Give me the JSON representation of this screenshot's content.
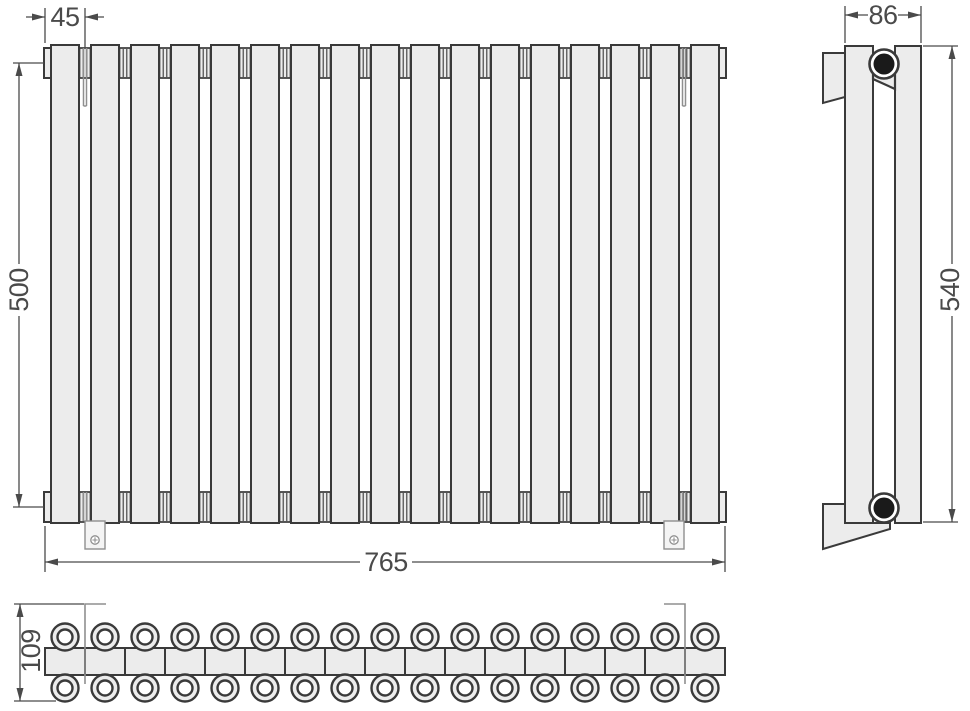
{
  "drawing": {
    "section_count": 17,
    "tube_rows": 2,
    "dimensions": {
      "bracket_offset_mm": "45",
      "center_distance_mm": "500",
      "width_mm": "765",
      "depth_mm": "86",
      "height_mm": "540",
      "overall_depth_mm": "109"
    },
    "colors": {
      "background": "#FFFFFF",
      "fill": "#ECECEC",
      "line": "#3A3A3A",
      "dim": "#4A4A4A",
      "thin": "#8F8F8F",
      "port": "#1A1A1A"
    }
  }
}
